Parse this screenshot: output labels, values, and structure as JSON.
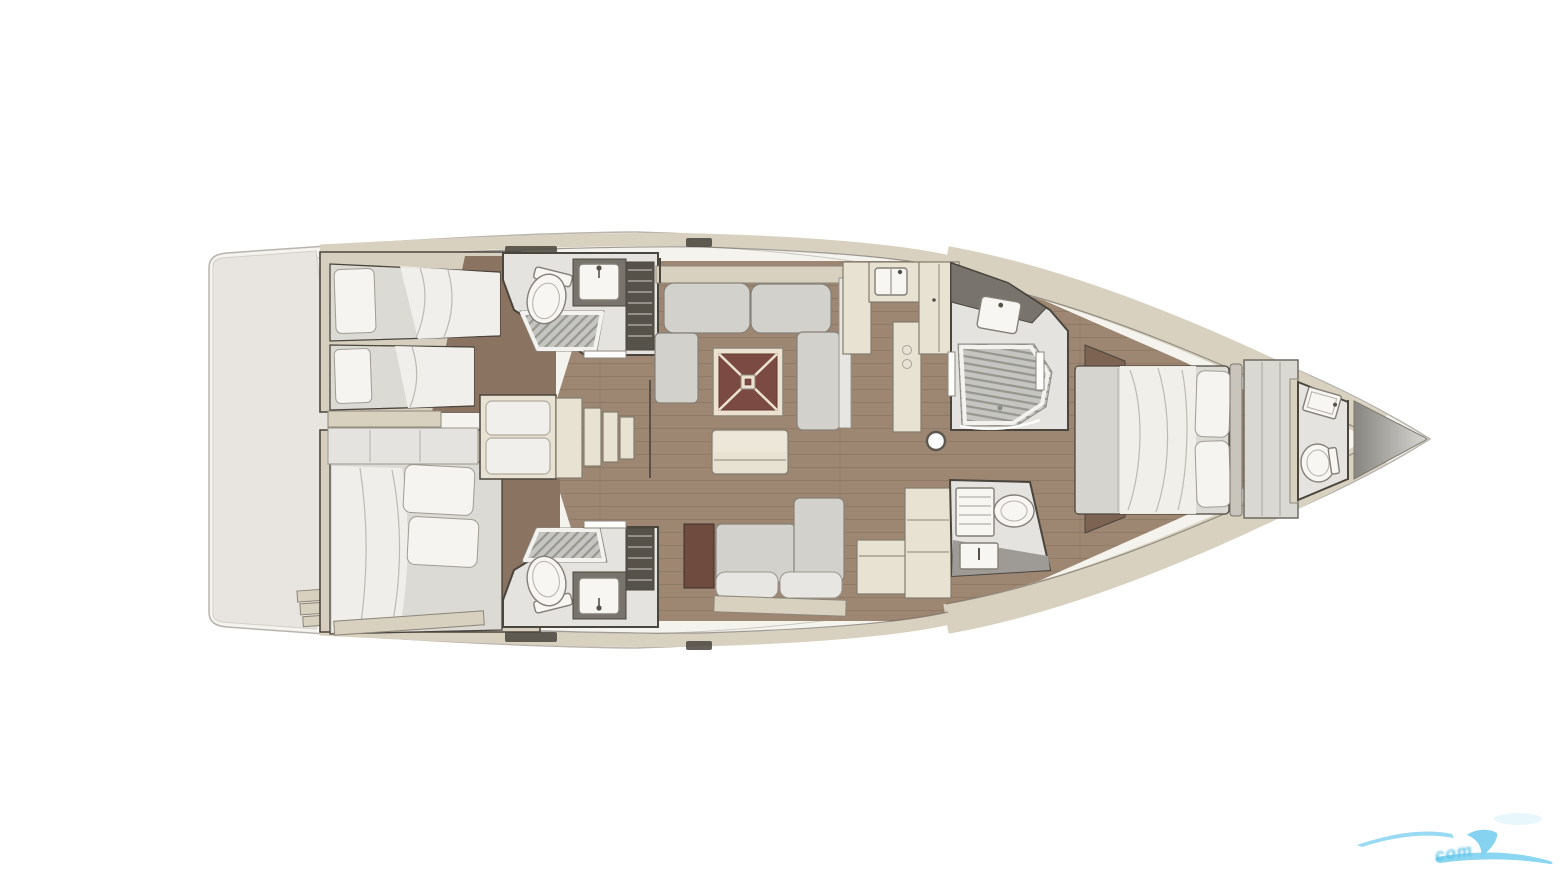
{
  "scene": {
    "subject": "sailboat-interior-layout-floorplan",
    "view": "top-down",
    "bow_direction": "right",
    "background_color": "#ffffff"
  },
  "palette": {
    "page_bg": "#ffffff",
    "hull_band": "#f5f3ee",
    "hull_stroke": "#b8b4ad",
    "stern_deck": "#e8e5e0",
    "lining_beige": "#d8d1c0",
    "panel_cream": "#e8e2d3",
    "cabin_beige": "#d6cebf",
    "wall_dark": "#4a453d",
    "wood_floor": "#9d8672",
    "wood_dark": "#8a7361",
    "walnut": "#7d6452",
    "mattress": "#dbdad5",
    "sheet_white": "#f1f0ec",
    "pillow_white": "#f5f4f0",
    "cushion_gray": "#d2d1cb",
    "cushion_edge": "#85817a",
    "table_red": "#7b4a42",
    "table_frame": "#ece2cf",
    "bath_floor": "#e4e3e0",
    "shower_fill": "#c5c5c1",
    "shower_stripe": "#97978f",
    "counter_dark": "#78746d",
    "grate_dark": "#56524a",
    "fixture_white": "#f7f6f3",
    "door_walnut": "#6f4b3f",
    "bow_locker_dark": "#87857f",
    "bow_locker_light": "#d8d6d2",
    "watermark_blue": "#7ed1f0",
    "watermark_text_blue": "#4fbde6"
  },
  "rooms": {
    "aft_cabin_port": {
      "furniture": [
        "twin-berth",
        "twin-berth",
        "pillows",
        "shelf"
      ]
    },
    "aft_cabin_starboard": {
      "furniture": [
        "double-berth",
        "pillows",
        "wardrobe"
      ]
    },
    "aft_head_port": {
      "furniture": [
        "toilet",
        "sink",
        "shower-pan",
        "slatted-locker"
      ]
    },
    "aft_head_starboard": {
      "furniture": [
        "toilet",
        "sink",
        "shower-pan",
        "slatted-locker"
      ]
    },
    "salon": {
      "furniture": [
        "u-shaped-sofa",
        "folding-table",
        "coffee-bench",
        "starboard-settee"
      ]
    },
    "galley": {
      "furniture": [
        "sink-counter",
        "worktop",
        "pantry-cabinet",
        "mast-post"
      ]
    },
    "companionway": {
      "furniture": [
        "engine-box-seat",
        "steps"
      ]
    },
    "nav_station": {
      "furniture": [
        "chart-desk",
        "cabinet"
      ]
    },
    "forward_shower_room": {
      "furniture": [
        "shower-pan",
        "vanity-sink",
        "glass-door"
      ]
    },
    "forward_head_starboard": {
      "furniture": [
        "toilet",
        "sink",
        "towel-shelf"
      ]
    },
    "master_cabin": {
      "furniture": [
        "island-double-bed",
        "pillows",
        "headboard",
        "wardrobe"
      ]
    },
    "bow_head": {
      "furniture": [
        "toilet",
        "sink"
      ]
    },
    "bow_locker": {
      "furniture": []
    },
    "stern": {
      "furniture": [
        "transom-platform",
        "steps"
      ]
    }
  },
  "watermark": {
    "text": "com",
    "color": "#7ed1f0",
    "position": "bottom-right",
    "style": "light-blue wave swoosh logo, cropped at right image edge"
  }
}
